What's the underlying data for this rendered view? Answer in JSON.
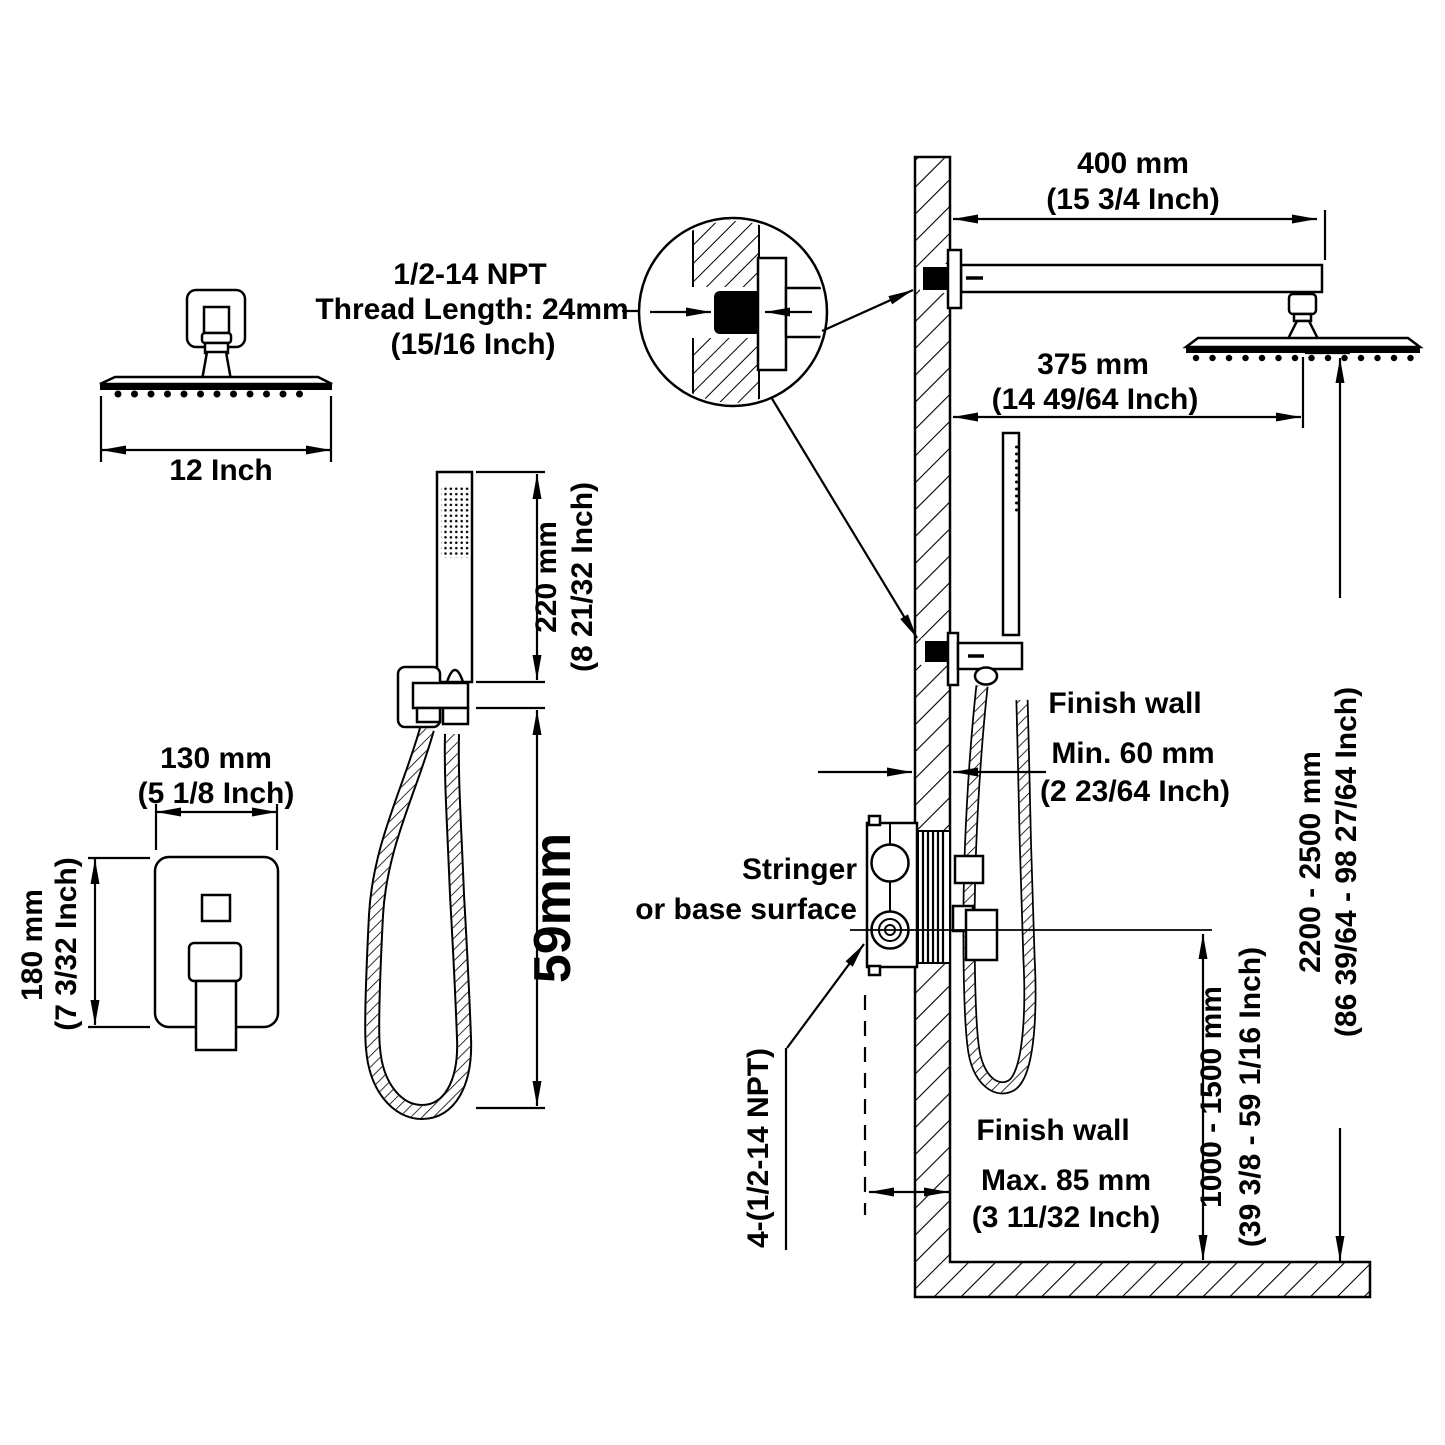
{
  "diagram": {
    "overhead_shower": {
      "size_label": "12 Inch"
    },
    "thread_callout": {
      "spec": "1/2-14 NPT",
      "length": "Thread Length: 24mm",
      "length_in": "(15/16 Inch)"
    },
    "shower_arm": {
      "length_mm": "400 mm",
      "length_in": "(15 3/4 Inch)"
    },
    "head_offset": {
      "mm": "375 mm",
      "in": "(14 49/64 Inch)"
    },
    "trim_plate": {
      "width_mm": "130 mm",
      "width_in": "(5 1/8 Inch)",
      "height_mm": "180 mm",
      "height_in": "(7 3/32 Inch)"
    },
    "handheld": {
      "length_mm": "220 mm",
      "length_in": "(8 21/32 Inch)",
      "holder_offset": "59mm"
    },
    "upper_wall": {
      "label": "Finish wall",
      "thickness_min": "Min. 60 mm",
      "thickness_min_in": "(2 23/64 Inch)"
    },
    "stringer": {
      "line1": "Stringer",
      "line2": "or base surface"
    },
    "ports": {
      "label": "4-(1/2-14 NPT)"
    },
    "lower_wall": {
      "label": "Finish wall",
      "thickness_max": "Max. 85 mm",
      "thickness_max_in": "(3 11/32 Inch)"
    },
    "valve_height": {
      "mm": "1000 - 1500 mm",
      "in": "(39 3/8 - 59 1/16 Inch)"
    },
    "head_height": {
      "mm": "2200 - 2500 mm",
      "in": "(86 39/64 - 98 27/64 Inch)"
    },
    "line_color": "#000000",
    "background_color": "#ffffff"
  }
}
